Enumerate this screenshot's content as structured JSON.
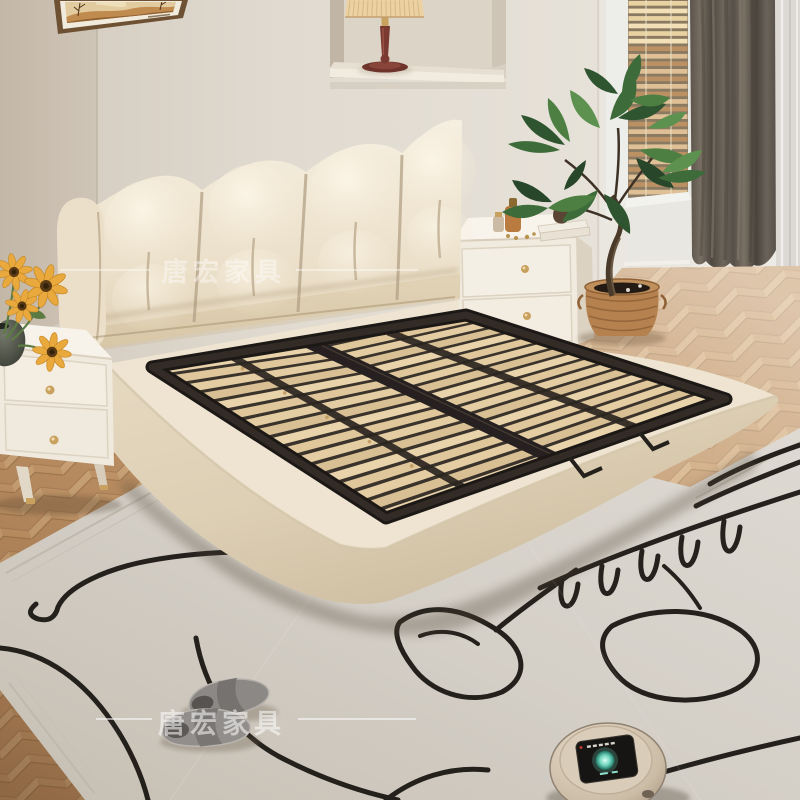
{
  "scene": {
    "description": "bedroom product photo of a floating upholstered bed frame with wood slats",
    "watermark_top": {
      "text": "唐宏家具"
    },
    "watermark_bottom": {
      "text": "唐宏家具"
    },
    "objects": [
      "tufted cream headboard",
      "floating upholstered bed base",
      "wood slat platform",
      "black metal support frame",
      "left nightstand with sunflowers in vase",
      "right nightstand with books and perfume bottles",
      "wall niche with table lamp",
      "framed abstract artwork",
      "wood venetian blinds",
      "dark gray curtain",
      "sheer curtain",
      "potted plant in rattan basket",
      "herringbone wood floor",
      "cream rug with black abstract line art",
      "gray slippers",
      "robot vacuum"
    ],
    "palette": {
      "wall": "#ded7cc",
      "wall_left": "#c8bdaf",
      "niche": "#d8d0c3",
      "headboard": "#f2e9d8",
      "bed_base": "#ebe1cd",
      "slats": "#e5cfa4",
      "metal_frame": "#26211d",
      "floor": "#c49a70",
      "rug": "#d4cfc7",
      "rug_lines": "#16120e",
      "curtain": "#5e574e",
      "sheer": "#dcd9d4",
      "blinds": "#dcbd8f",
      "plant": "#3f6b3a",
      "basket": "#b5824f",
      "lamp_shade": "#ecd2a2",
      "lamp_stem": "#7b3a31",
      "vacuum_body": "#cfc1ac",
      "vacuum_glow": "#6fd4bd",
      "slippers": "#8b8886",
      "nightstand": "#f2ece2",
      "knob_gold": "#c9a15e"
    }
  }
}
